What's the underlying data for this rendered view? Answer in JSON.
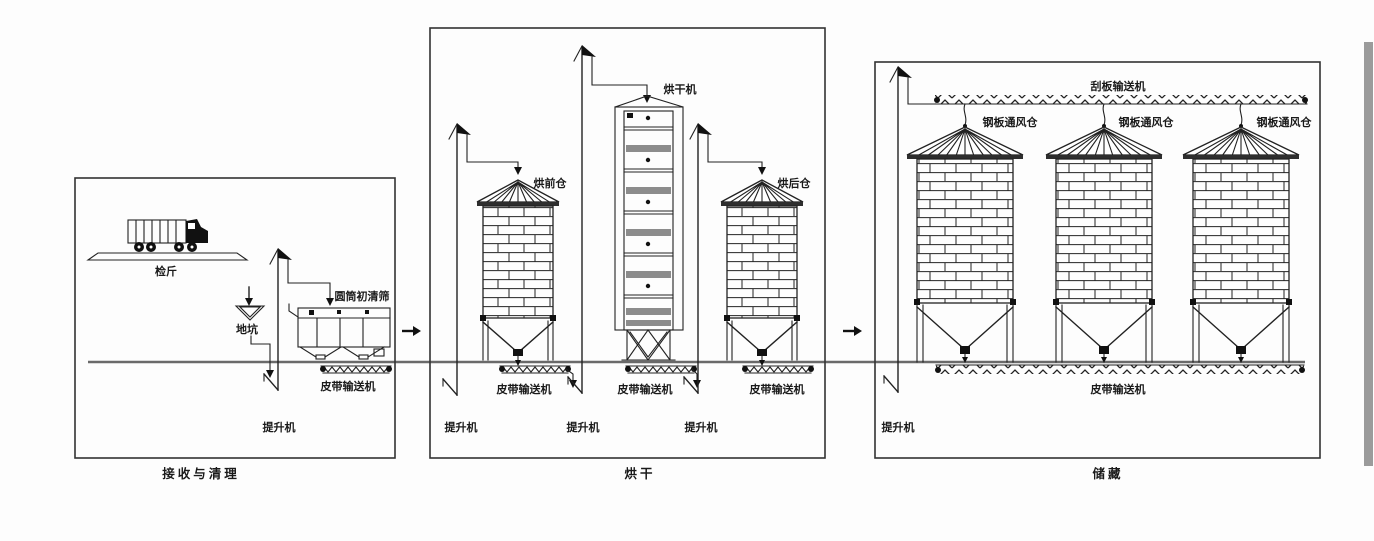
{
  "colors": {
    "line": "#222222",
    "ground": "#6a6a6a",
    "dryer_band": "#8c8c8c",
    "label_text": "#1a1a1a",
    "scan_edge_bar": "#9b9b9b",
    "background": "#fdfdfd"
  },
  "sections": {
    "receiving": {
      "title": "接收与清理",
      "labels": {
        "weighbridge": "检斤",
        "pit": "地坑",
        "drum_precleaner": "圆筒初清筛",
        "belt_conveyor": "皮带输送机",
        "elevator": "提升机"
      }
    },
    "drying": {
      "title": "烘干",
      "labels": {
        "pre_dry_bin": "烘前仓",
        "dryer": "烘干机",
        "post_dry_bin": "烘后仓",
        "belt_conveyor_1": "皮带输送机",
        "belt_conveyor_2": "皮带输送机",
        "belt_conveyor_3": "皮带输送机",
        "elevator_1": "提升机",
        "elevator_2": "提升机",
        "elevator_3": "提升机"
      }
    },
    "storage": {
      "title": "储藏",
      "labels": {
        "scraper_conveyor": "刮板输送机",
        "vent_bin_1": "钢板通风仓",
        "vent_bin_2": "钢板通风仓",
        "vent_bin_3": "钢板通风仓",
        "belt_conveyor": "皮带输送机",
        "elevator": "提升机"
      }
    }
  }
}
